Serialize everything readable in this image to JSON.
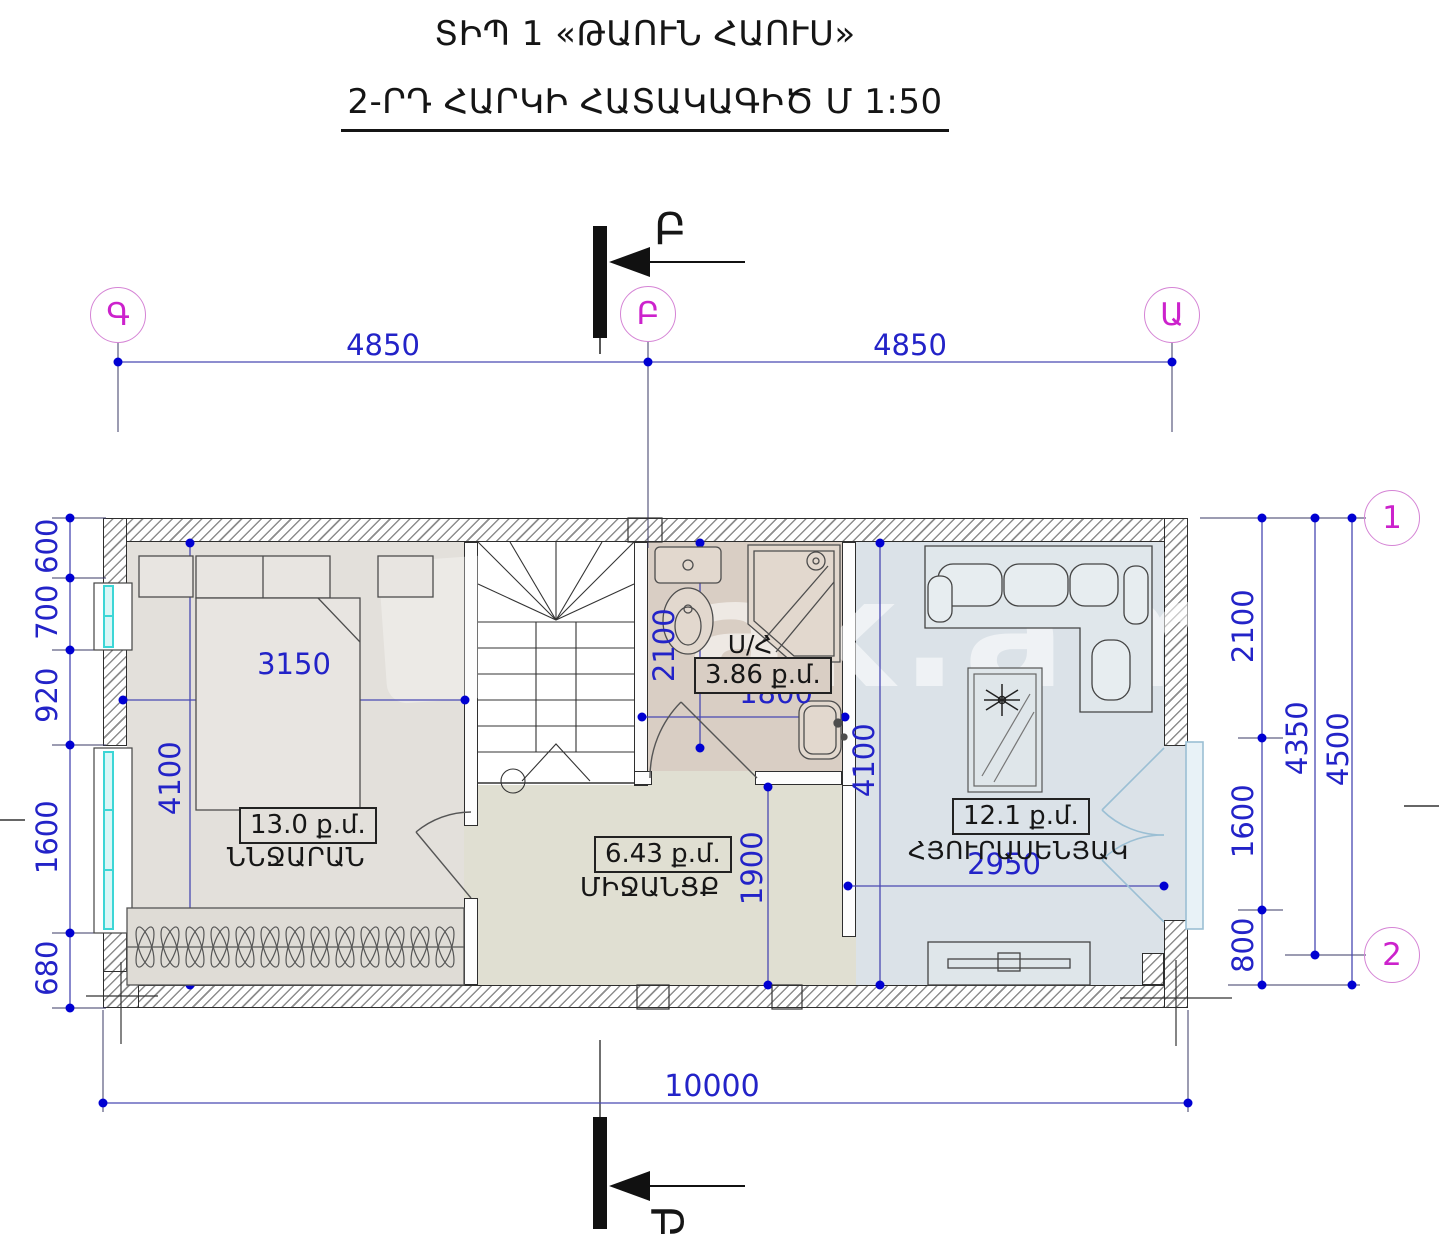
{
  "title": {
    "line1": "ՏԻՊ 1 «ԹԱՈՒՆ ՀԱՈՒՍ»",
    "line2": "2-ՐԴ ՀԱՐԿԻ ՀԱՏԱԿԱԳԻԾ  Մ 1:50"
  },
  "axes": {
    "col_left": "Գ",
    "col_mid": "Բ",
    "col_right": "Ա",
    "row_top": "1",
    "row_bottom": "2",
    "section_top": "Բ",
    "section_bottom": "Բ"
  },
  "dims": {
    "top_left": "4850",
    "top_right": "4850",
    "bottom": "10000",
    "left_chain": [
      "600",
      "700",
      "920",
      "1600",
      "680"
    ],
    "right_chain": [
      "2100",
      "1600",
      "800"
    ],
    "right_mid": "4350",
    "right_outer": "4500",
    "bedroom_w": "3150",
    "bedroom_h": "4100",
    "bath_h": "2100",
    "bath_w": "1800",
    "hall_h": "1900",
    "living_h": "4100",
    "living_w": "2950"
  },
  "rooms": {
    "bedroom": {
      "area": "13.0 ք.մ.",
      "name": "ՆՆՋԱՐԱՆ"
    },
    "hall": {
      "area": "6.43 ք.մ.",
      "name": "ՄԻՋԱՆՑՔ"
    },
    "bath": {
      "label": "Ս/Հ",
      "area": "3.86 ք.մ."
    },
    "living": {
      "area": "12.1 ք.մ.",
      "name": "ՀՅՈՒՐԱՍԵՆՅԱԿ"
    }
  },
  "watermark": {
    "text": "ak.am"
  },
  "colors": {
    "dim_blue": "#2323c8",
    "dot_blue": "#0000d2",
    "magenta": "#cc22cc",
    "bedroom_fill": "#e3e0db",
    "bath_fill": "#d9cec4",
    "hall_fill": "#e0dfd2",
    "living_fill": "#dbe2e8",
    "window_cyan": "#3cd6d6",
    "balcony_blue": "#9bbfd4"
  }
}
